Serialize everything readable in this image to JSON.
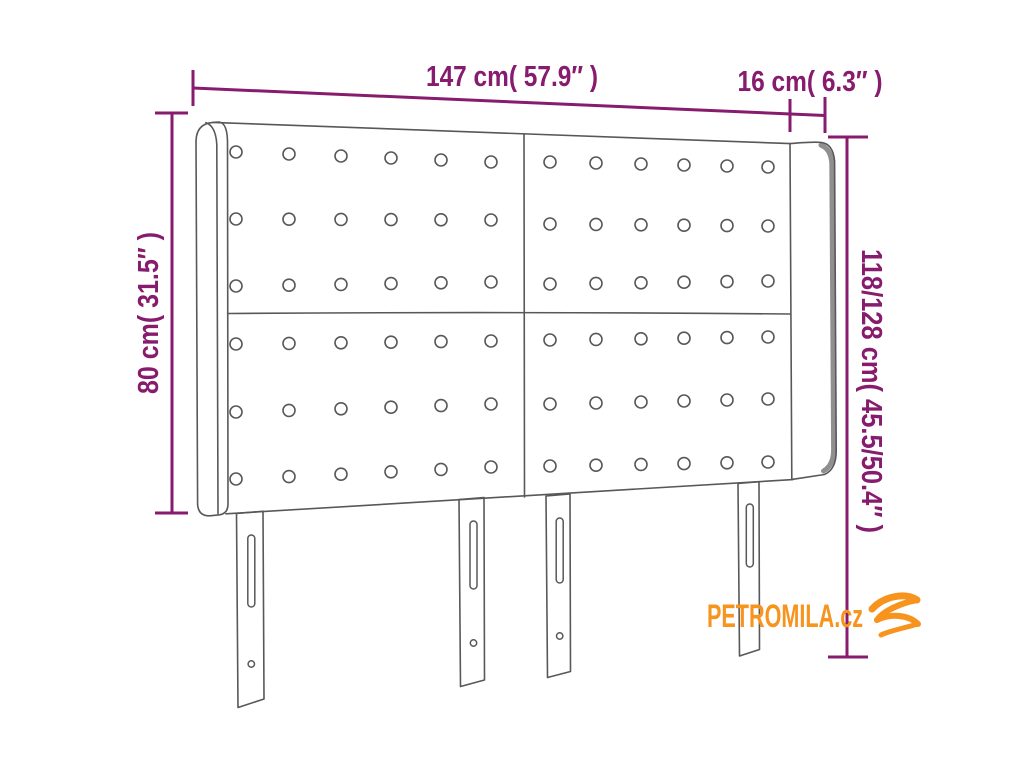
{
  "diagram": {
    "dimension_labels": {
      "width": "147 cm( 57.9″ )",
      "ear_depth": "16 cm( 6.3″ )",
      "panel_height": "80 cm( 31.5″ )",
      "total_height": "118/128 cm( 45.5/50.4″ )"
    },
    "watermark": "PETROMILA.cz",
    "colors": {
      "dimension": "#871b6e",
      "outline": "#58585a",
      "shade": "#8f8f8f",
      "logo": "#f7941e"
    },
    "buttons": {
      "radius": 6,
      "panels": [
        {
          "cols": [
            236,
            289,
            341,
            391,
            441,
            491
          ],
          "rows": [
            [
              152,
              162
            ],
            [
              219,
              220
            ],
            [
              286,
              282
            ],
            [
              344,
              341
            ],
            [
              412,
              404
            ],
            [
              479,
              467
            ]
          ]
        },
        {
          "cols": [
            550,
            596,
            641,
            684,
            727,
            768
          ],
          "rows": [
            [
              162,
              167
            ],
            [
              224,
              226
            ],
            [
              284,
              281
            ],
            [
              340,
              337
            ],
            [
              404,
              399
            ],
            [
              466,
              462
            ]
          ]
        }
      ]
    }
  }
}
